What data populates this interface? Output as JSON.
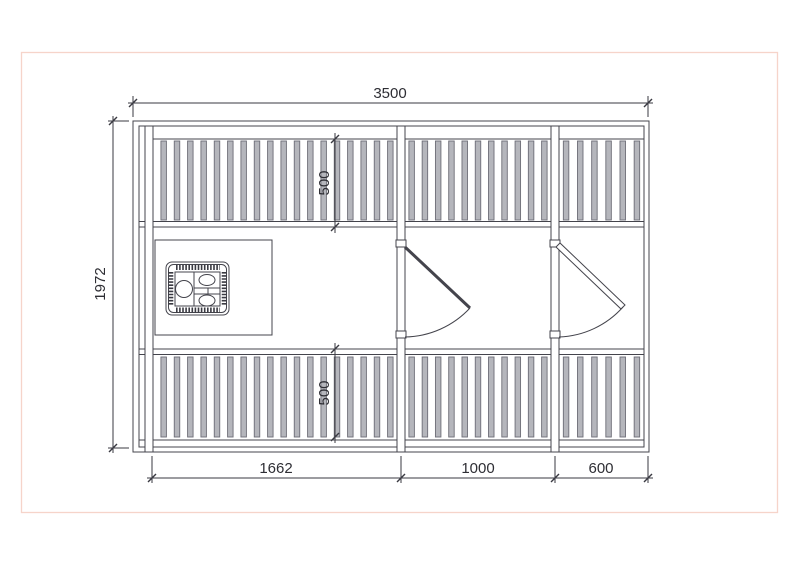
{
  "sheet": {
    "background": "#ffffff",
    "border_color": "#f6d4ca"
  },
  "drawing": {
    "line_color": "#44444c",
    "slat_fill": "#b5b6bc",
    "slat_stroke": "#6d6d77",
    "dims": {
      "overall_width": "3500",
      "overall_depth": "1972",
      "top_bench_depth": "500",
      "bottom_bench_depth": "500",
      "bay_left": "1662",
      "bay_middle": "1000",
      "bay_right": "600"
    }
  }
}
